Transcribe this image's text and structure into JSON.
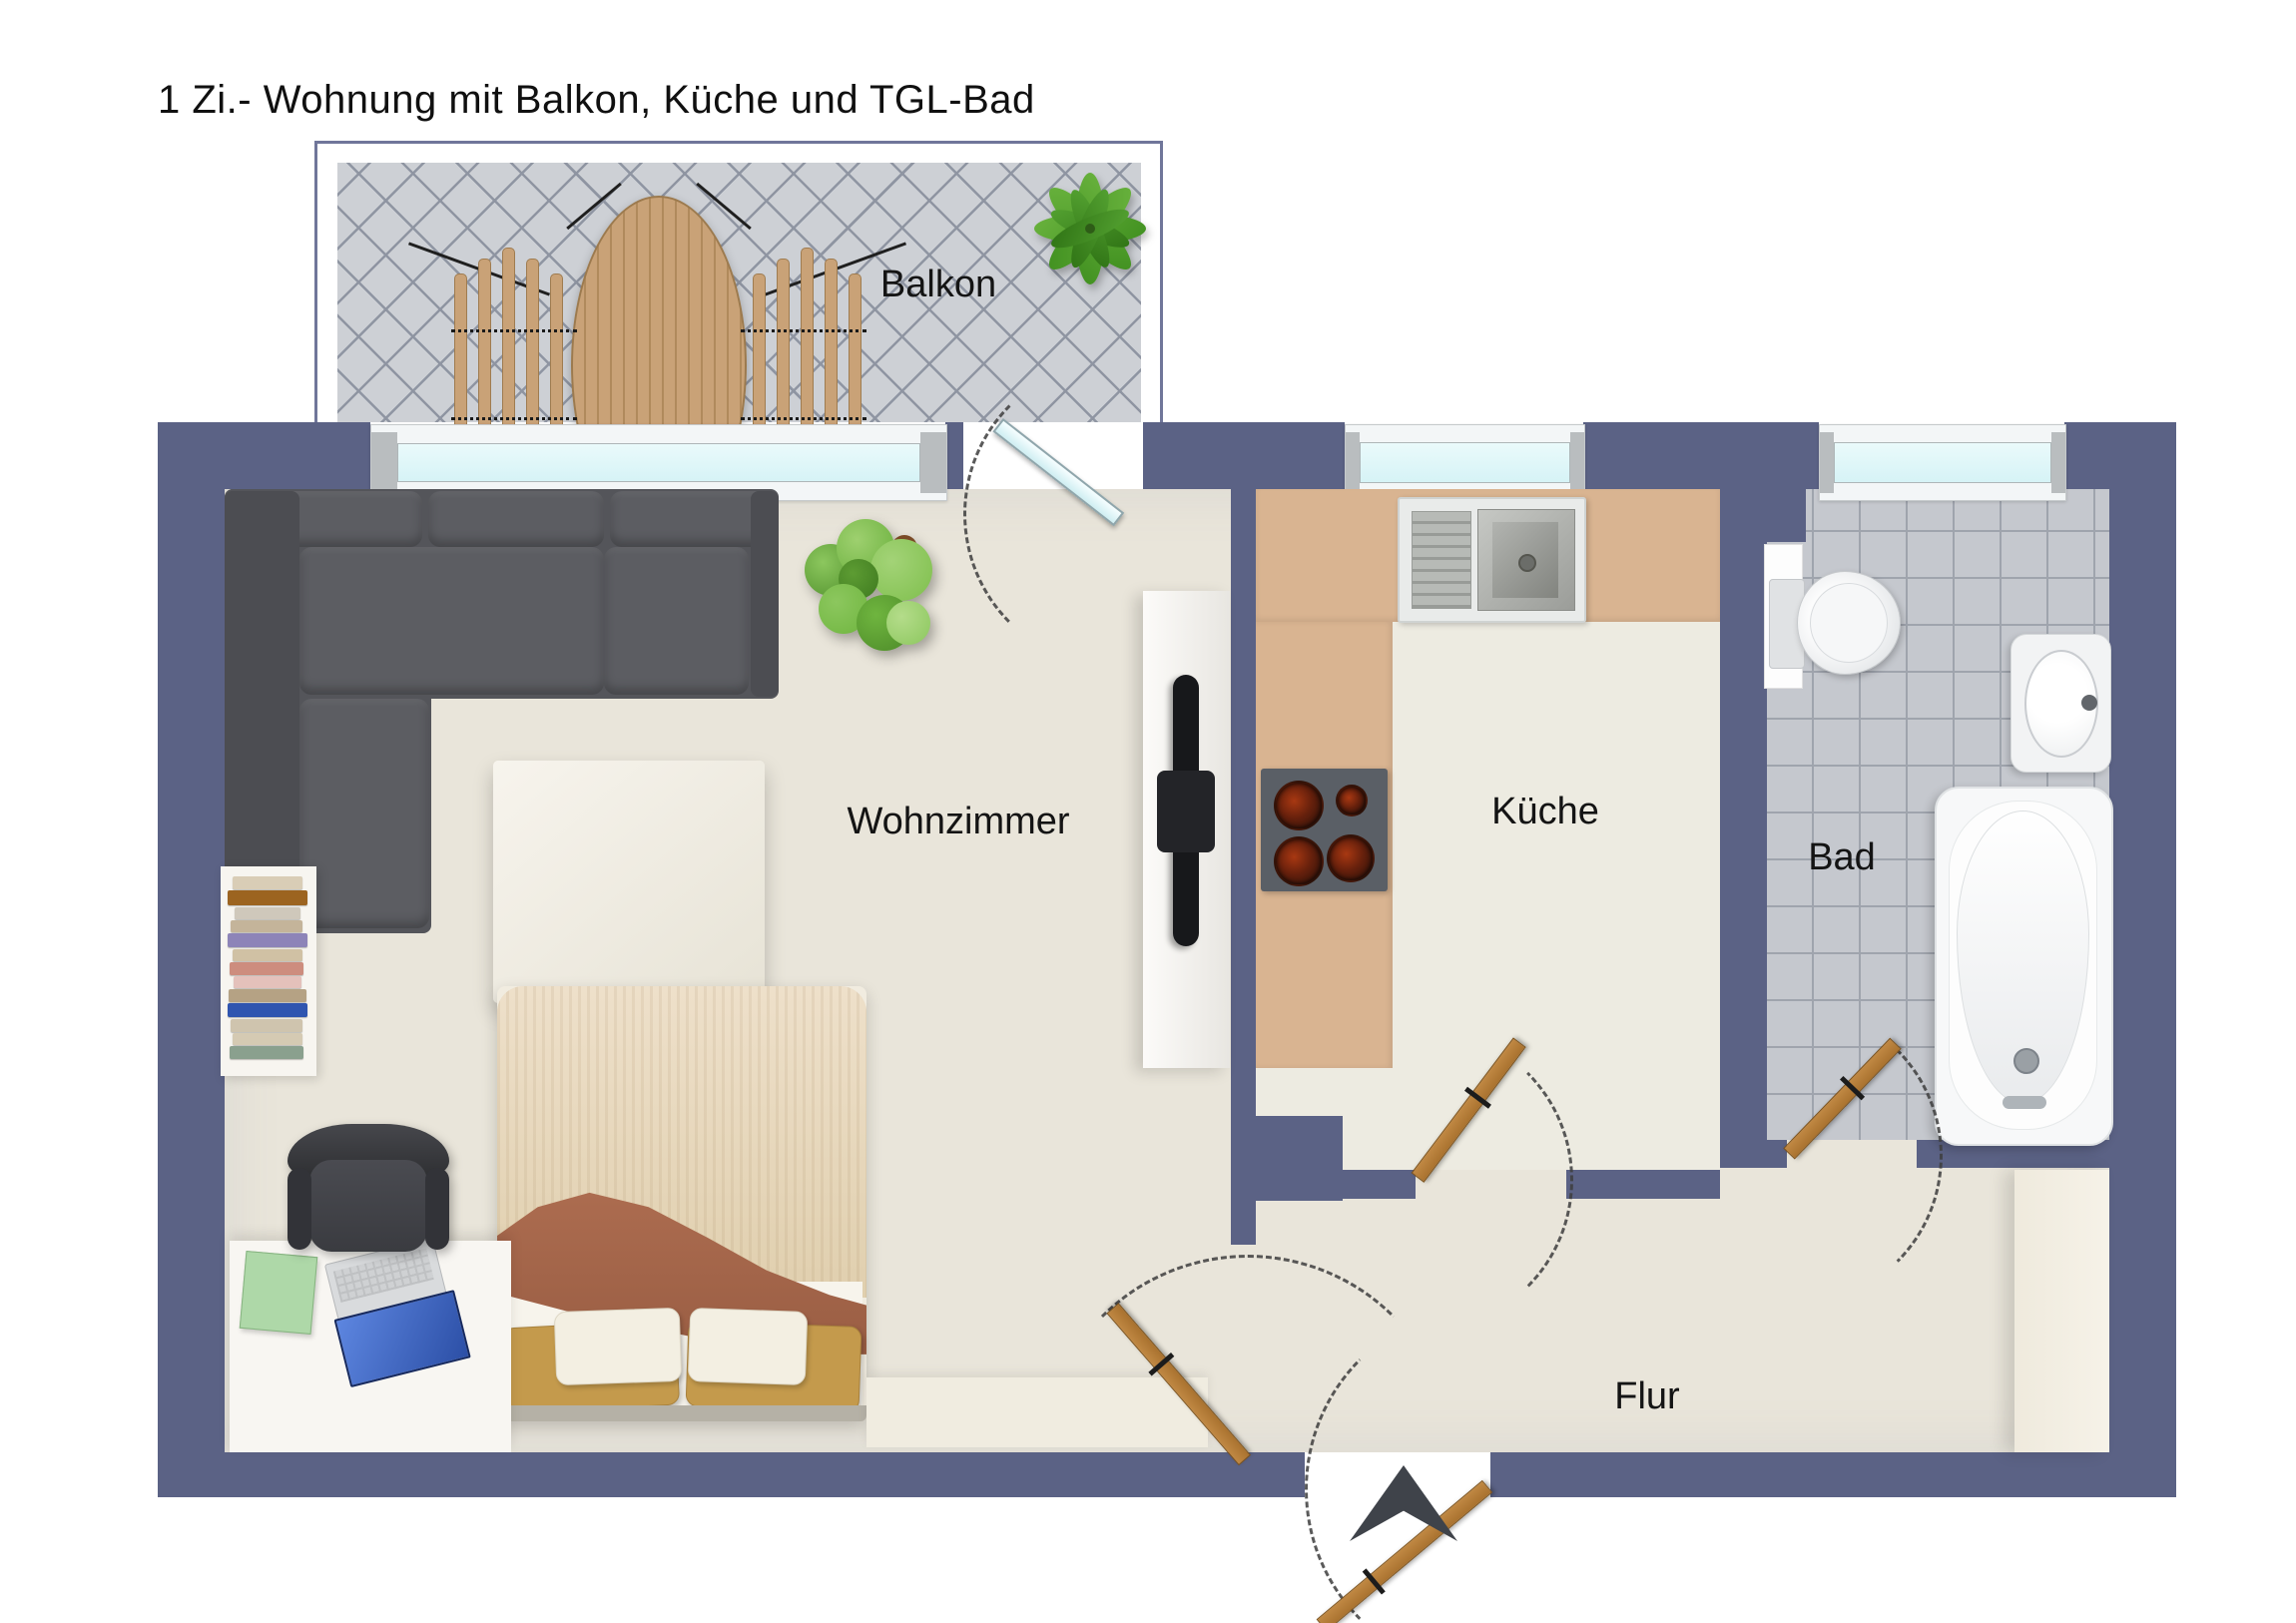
{
  "title": "1 Zi.- Wohnung mit Balkon, Küche und TGL-Bad",
  "rooms": {
    "balcony": {
      "label": "Balkon"
    },
    "living_room": {
      "label": "Wohnzimmer"
    },
    "kitchen": {
      "label": "Küche"
    },
    "bathroom": {
      "label": "Bad"
    },
    "hallway": {
      "label": "Flur"
    }
  },
  "palette": {
    "wall": "#5b6285",
    "balcony_railing": "#70769a",
    "floor": "#e9e5da",
    "kitchen_floor": "#edebe1",
    "balcony_tile": "#cdd0d5",
    "bath_tile": "#c5c8ce",
    "counter": "#d9b491",
    "door_wood": "#b67f3e",
    "window_glass": "#ddf6f8",
    "sofa": "#54555a",
    "bed_blanket": "#a8664e",
    "plant_green": "#55a332",
    "entrance_arrow": "#3f434a"
  }
}
